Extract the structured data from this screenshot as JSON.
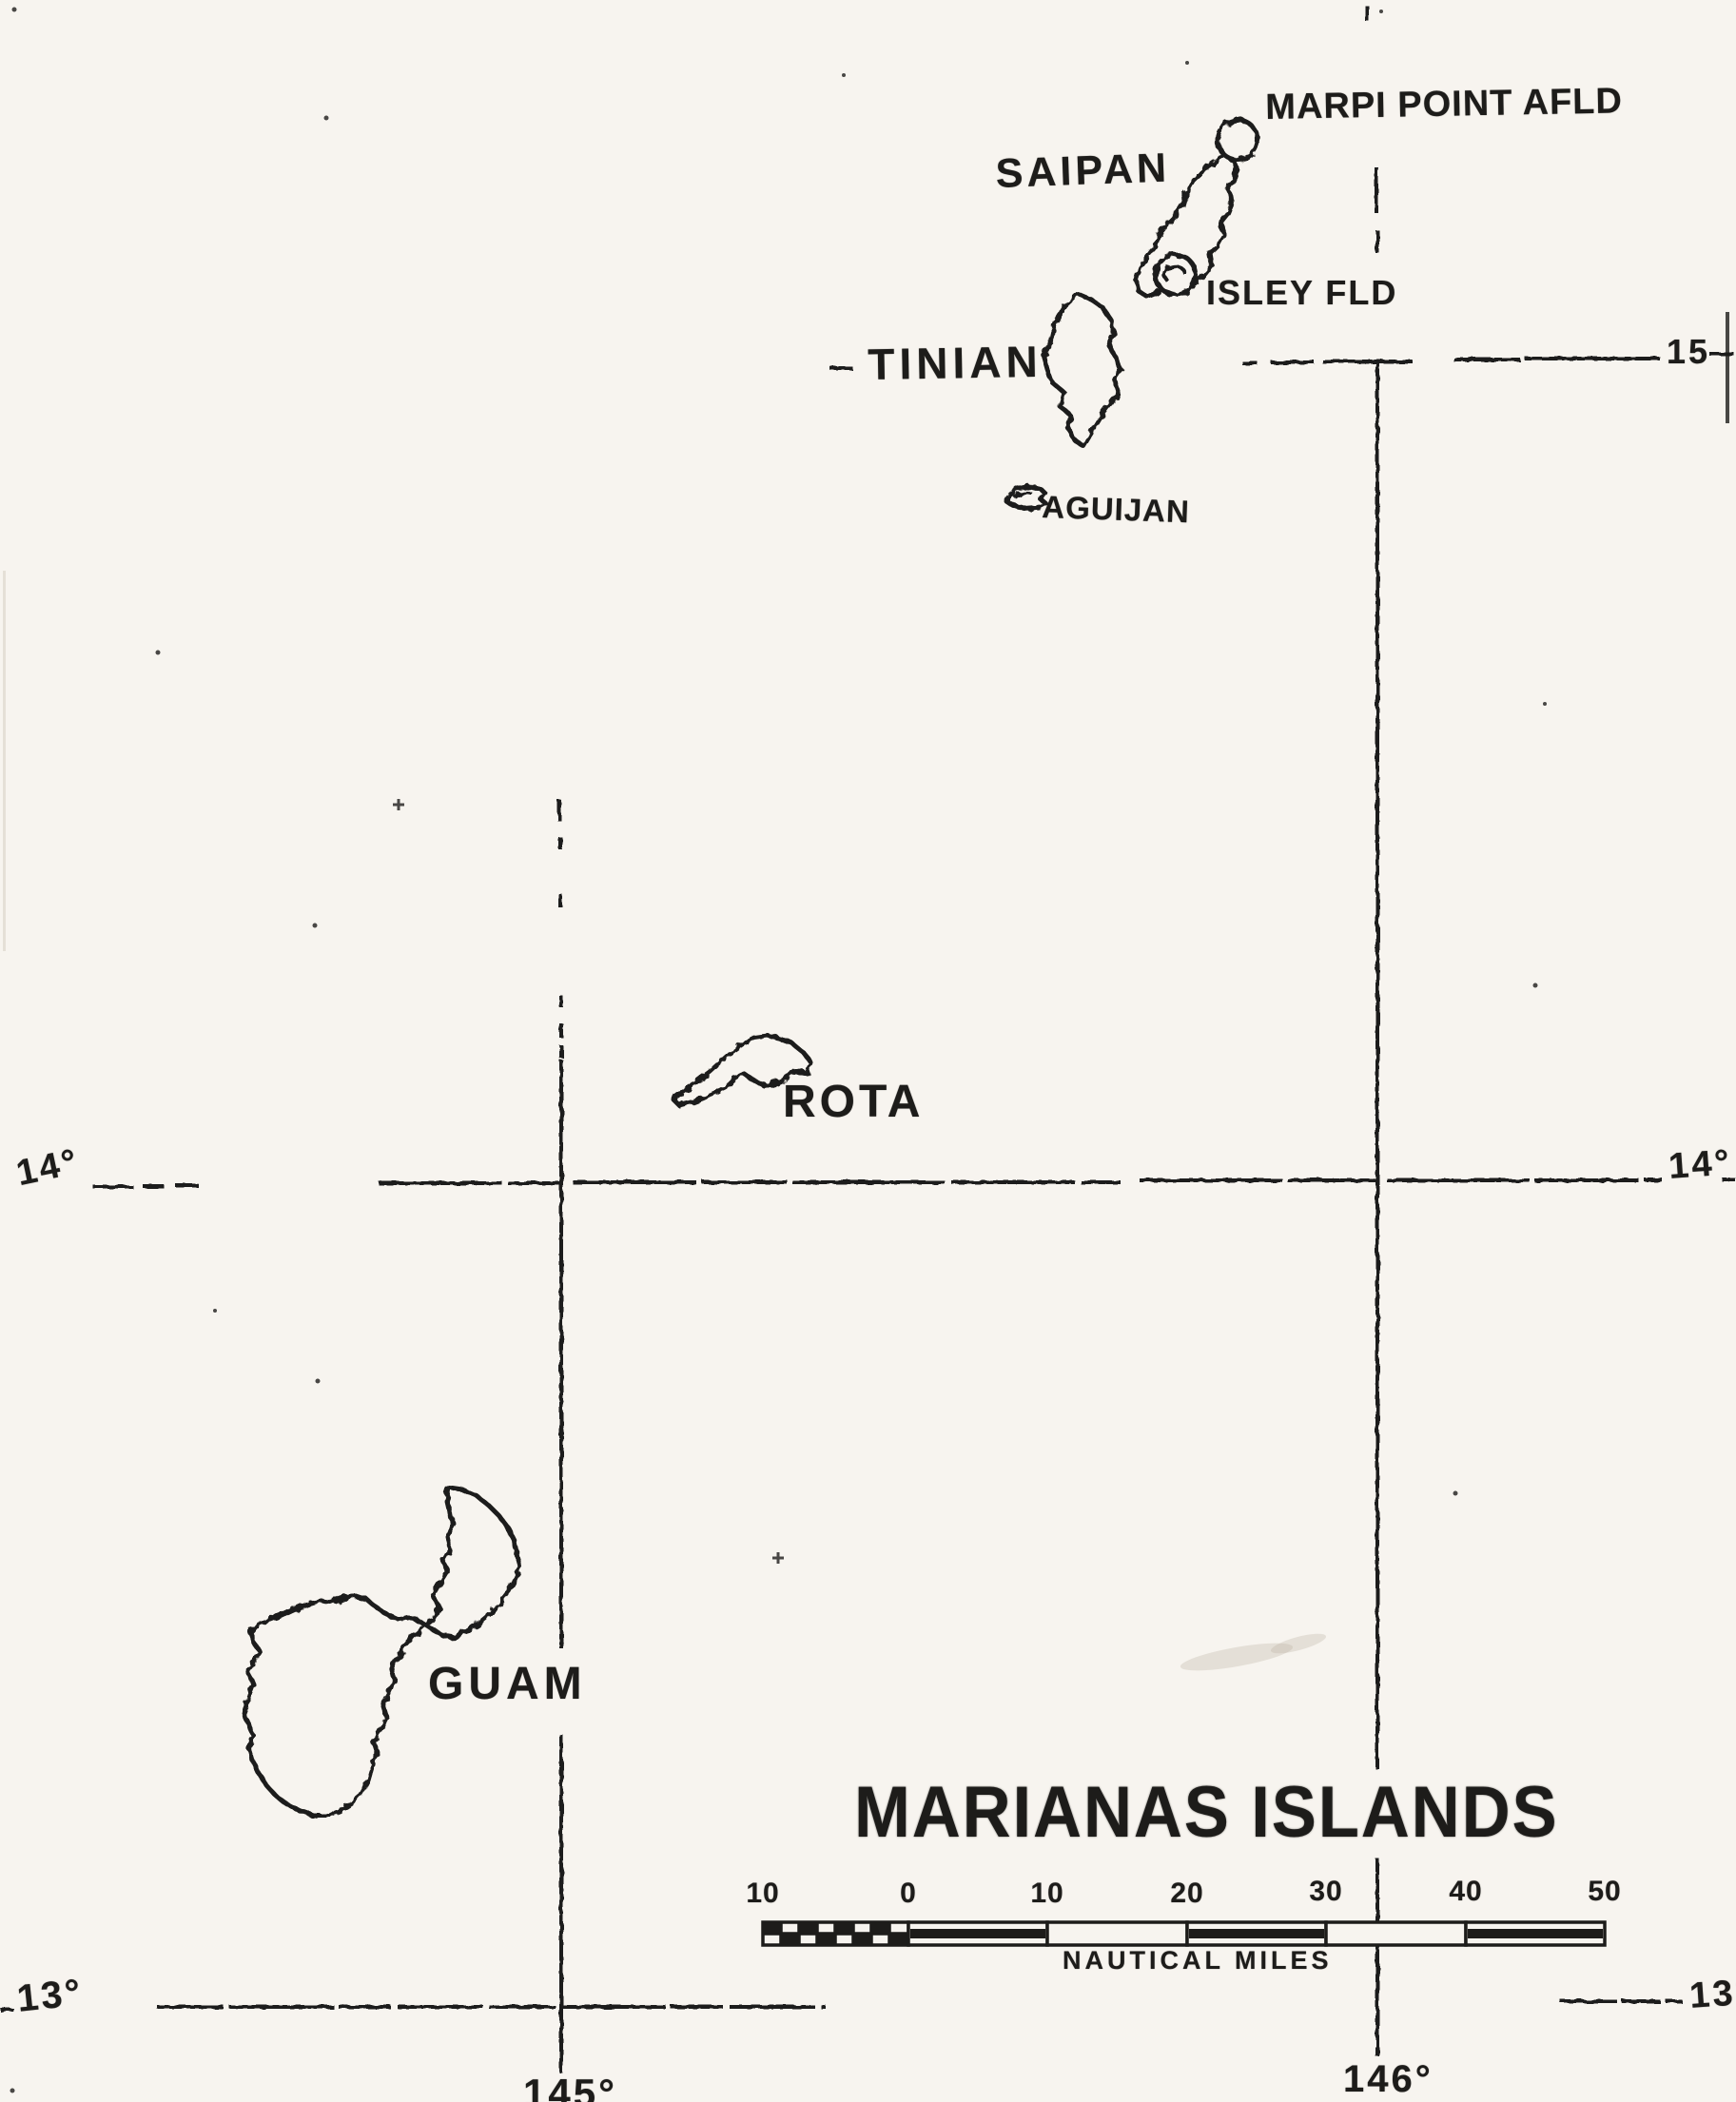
{
  "title": "MARIANAS ISLANDS",
  "islands": {
    "saipan": "SAIPAN",
    "tinian": "TINIAN",
    "aguijan": "AGUIJAN",
    "rota": "ROTA",
    "guam": "GUAM"
  },
  "airfields": {
    "marpi_point": "MARPI POINT AFLD",
    "isley": "ISLEY FLD"
  },
  "graticule": {
    "lat_15_right": "15",
    "lat_14_left": "14°",
    "lat_14_right": "14°",
    "lat_13_left": "13°",
    "lat_13_right": "13°",
    "lon_145": "145°",
    "lon_146": "146°"
  },
  "scale": {
    "ticks": [
      "10",
      "0",
      "10",
      "20",
      "30",
      "40",
      "50"
    ],
    "units_label": "NAUTICAL MILES"
  },
  "colors": {
    "ink": "#1d1c1a",
    "paper": "#f7f4ef"
  }
}
